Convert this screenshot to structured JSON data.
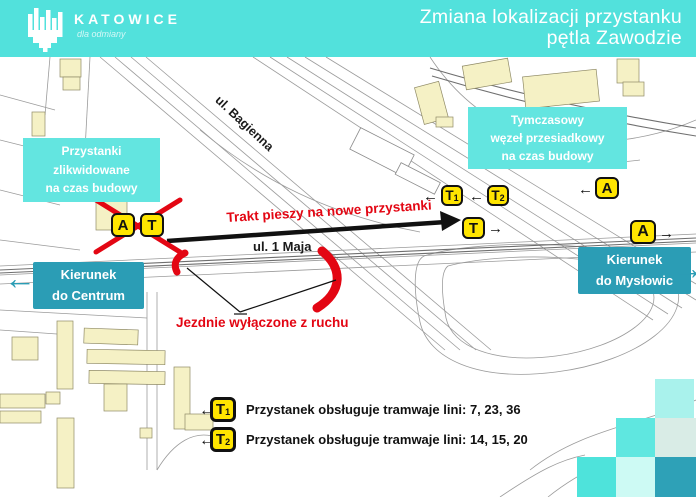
{
  "theme": {
    "header_bg": "#52E1DC",
    "callout_bg": "#63E5E0",
    "direction_bg": "#2B9DB5",
    "badge_yellow": "#FFE500",
    "alert_red": "#E30613"
  },
  "header": {
    "logo_text": "KATOWICE",
    "tagline": "dla odmiany",
    "title_line1": "Zmiana lokalizacji przystanku",
    "title_line2": "pętla Zawodzie"
  },
  "map": {
    "street_labels": {
      "bagienna": "ul. Bagienna",
      "maja": "ul. 1 Maja"
    },
    "annotations": {
      "walkway": "Trakt pieszy na nowe przystanki",
      "closed_roads": "Jezdnie wyłączone z ruchu"
    },
    "callouts": {
      "removed": {
        "line1": "Przystanki zlikwidowane",
        "line2": "na czas budowy"
      },
      "hub": {
        "line1": "Tymczasowy",
        "line2": "węzeł przesiadkowy",
        "line3": "na czas budowy"
      },
      "centrum": {
        "line1": "Kierunek",
        "line2": "do Centrum"
      },
      "myslowic": {
        "line1": "Kierunek",
        "line2": "do Mysłowic"
      }
    },
    "markers": [
      {
        "label": "A"
      },
      {
        "label": "T"
      },
      {
        "label": "T",
        "sub": "1"
      },
      {
        "label": "T",
        "sub": "2"
      },
      {
        "label": "A"
      },
      {
        "label": "T"
      },
      {
        "label": "A"
      }
    ]
  },
  "legend": {
    "items": [
      {
        "badge": "T",
        "sub": "1",
        "text": "Przystanek obsługuje tramwaje lini: 7, 23, 36"
      },
      {
        "badge": "T",
        "sub": "2",
        "text": "Przystanek obsługuje tramwaje lini: 14, 15, 20"
      }
    ]
  }
}
